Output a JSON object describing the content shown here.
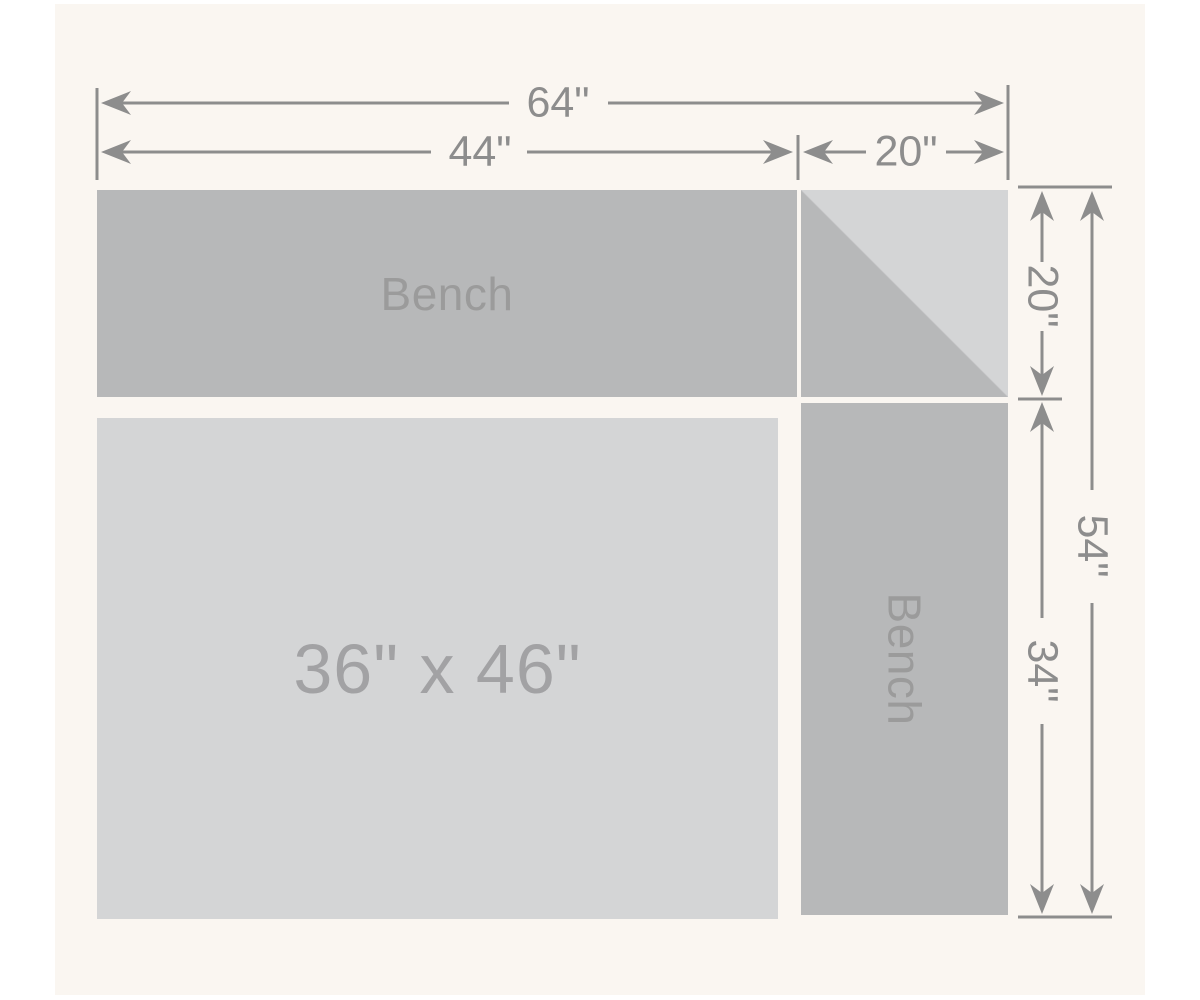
{
  "diagram": {
    "type": "corner-bench-seating-plan",
    "colors": {
      "page_bg": "#ffffff",
      "panel_bg": "#faf6f1",
      "bench_fill": "#b7b8b9",
      "table_fill": "#d4d5d6",
      "dim_color": "#8d8d8d",
      "shape_label_color": "#9b9b9b",
      "table_label_color": "#a2a2a4"
    },
    "shapes": {
      "bench_top_label": "Bench",
      "bench_right_label": "Bench",
      "table_label": "36\" x 46\""
    },
    "dims": {
      "total_width": "64\"",
      "bench_top_width": "44\"",
      "corner_width": "20\"",
      "corner_height": "20\"",
      "total_height": "54\"",
      "bench_right_height": "34\""
    }
  }
}
